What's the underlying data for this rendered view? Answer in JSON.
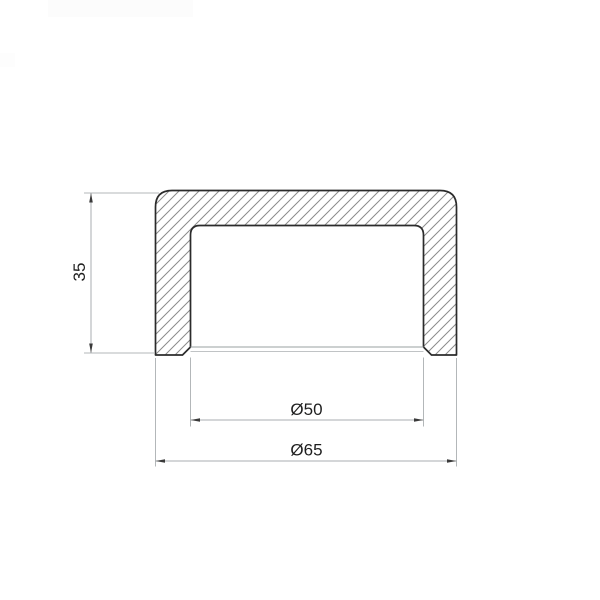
{
  "drawing": {
    "type": "technical-section-drawing",
    "subject": "pipe-end-cap-cross-section",
    "background": "#ffffff",
    "colors": {
      "outline": "#2b2b2b",
      "hatch": "#8b8b8b",
      "dimension_line": "#aaaeb1",
      "extension_line": "#b3b7b9",
      "arrowhead": "#3a3a3a",
      "text": "#1f1f1f",
      "opening_edge": "#9aa0a2"
    },
    "dimensions": {
      "height": {
        "label": "35",
        "orientation": "vertical"
      },
      "inner_diameter": {
        "label": "Ø50",
        "orientation": "horizontal"
      },
      "outer_diameter": {
        "label": "Ø65",
        "orientation": "horizontal"
      }
    }
  }
}
